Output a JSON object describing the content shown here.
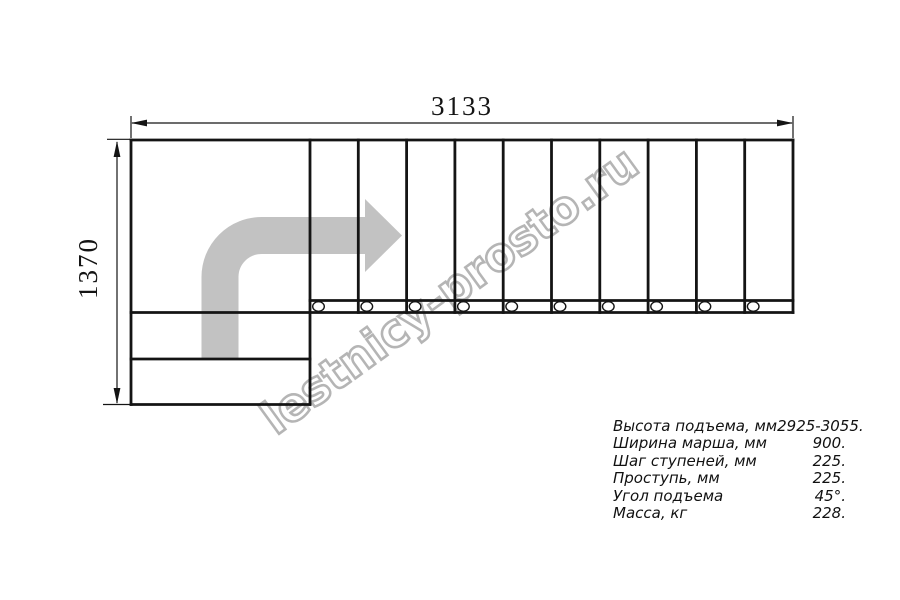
{
  "watermark": "lestnicy-prosto.ru",
  "dimensions": {
    "width_label": "3133",
    "height_label": "1370"
  },
  "plan": {
    "tread_count": 10,
    "lower_step_count": 2,
    "flow_arrow": "quarter-turn-right"
  },
  "specs": {
    "rows": [
      {
        "label": "Высота подъема, мм",
        "value": "2925-3055."
      },
      {
        "label": "Ширина марша, мм",
        "value": "900."
      },
      {
        "label": "Шаг ступеней, мм",
        "value": "225."
      },
      {
        "label": "Проступь, мм",
        "value": "225."
      },
      {
        "label": "Угол подъема",
        "value": "45°."
      },
      {
        "label": "Масса, кг",
        "value": "228."
      }
    ]
  },
  "colors": {
    "line": "#141414",
    "arrow": "#c2c2c2",
    "watermark": "#b5b5b5"
  }
}
